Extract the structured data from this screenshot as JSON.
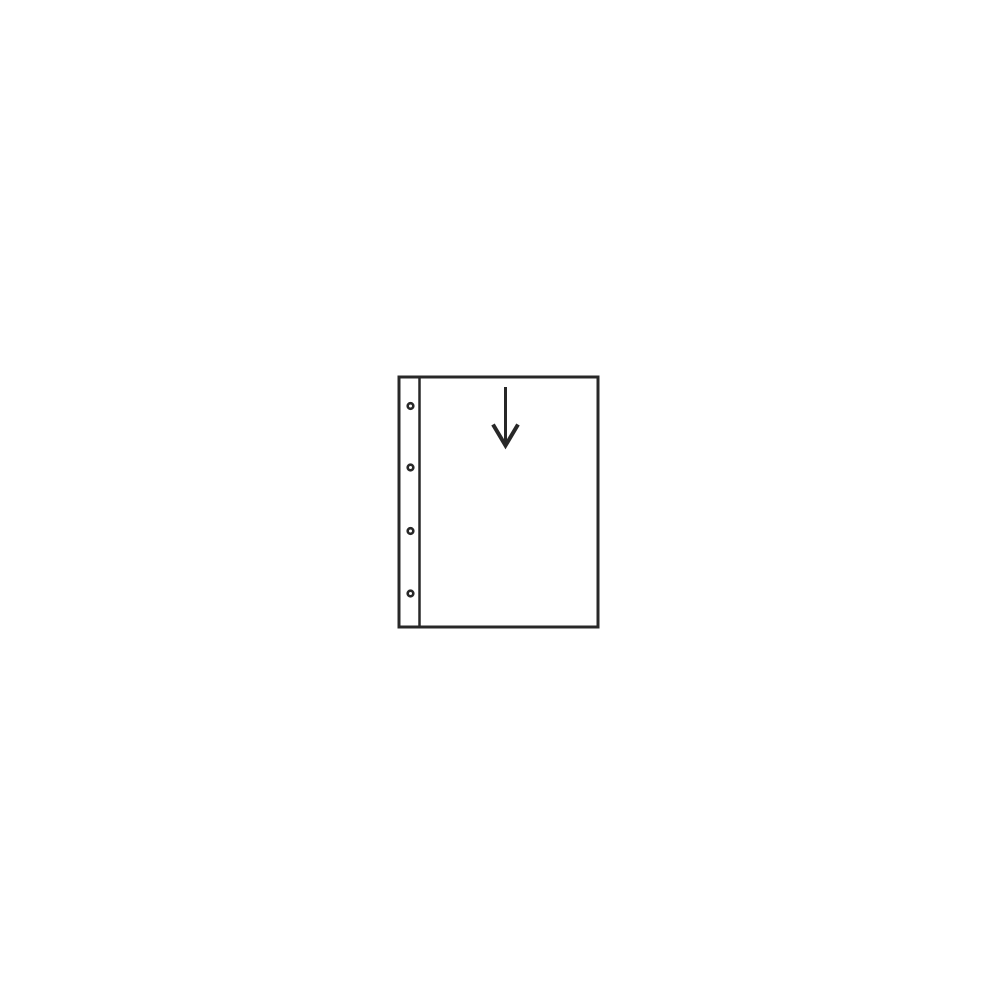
{
  "canvas": {
    "width": 1000,
    "height": 1000,
    "background_color": "#ffffff"
  },
  "diagram": {
    "name": "binder-page-insert-diagram",
    "description": "line drawing of a ring-binder pocket page with four punched holes and an arrow showing top insertion",
    "stroke_color": "#282828",
    "fill_color": "#ffffff",
    "page_outline": {
      "x": 399,
      "y": 377,
      "width": 199,
      "height": 250,
      "stroke_width": 3
    },
    "binding_divider": {
      "x": 419.5,
      "y1": 377,
      "y2": 627,
      "stroke_width": 2.5
    },
    "binding_holes": {
      "cx": 410.5,
      "radius": 2.8,
      "stroke_width": 2.6,
      "cy": [
        406,
        467.5,
        531,
        593.5
      ]
    },
    "insert_arrow": {
      "shaft_x": 505.5,
      "shaft_y1": 387,
      "shaft_y2": 442,
      "shaft_stroke_width": 3,
      "head_points": "493,424.5 505.5,445.5 518,424.5",
      "head_stroke_width": 4
    }
  }
}
